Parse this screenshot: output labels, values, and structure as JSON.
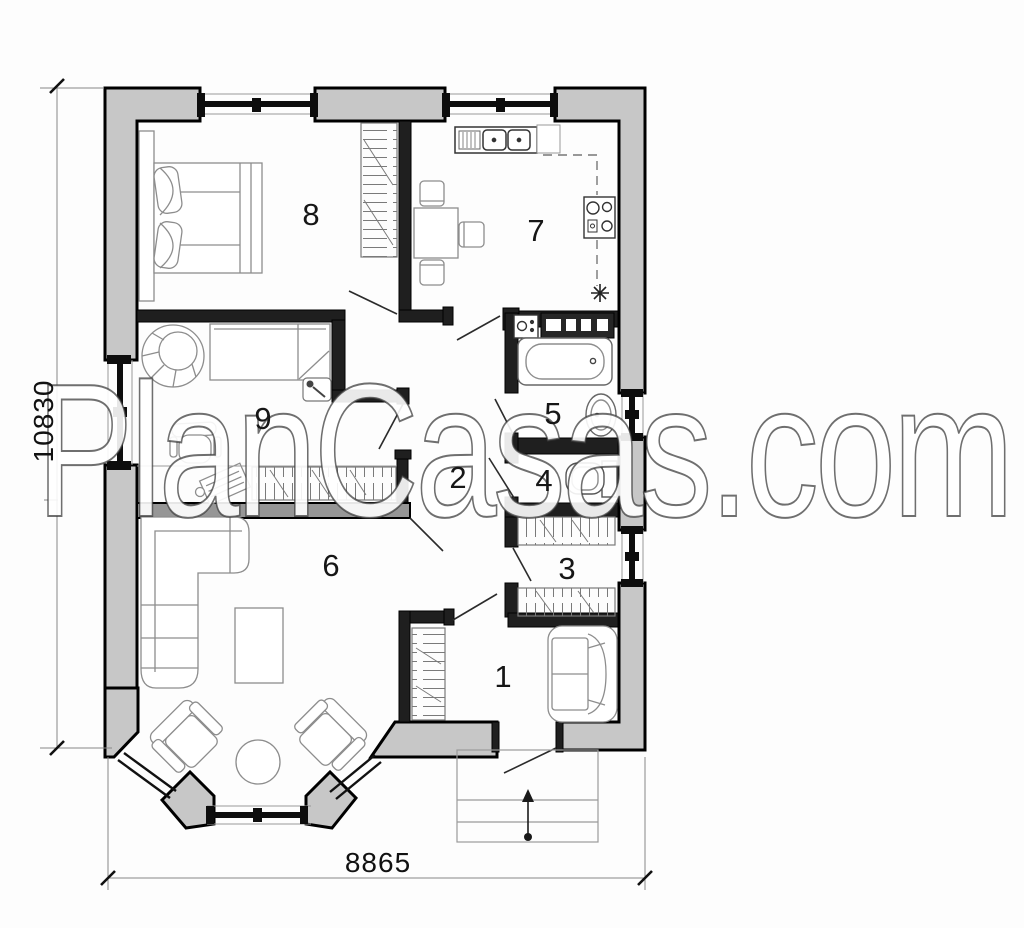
{
  "watermark": {
    "text": "PlanCasas.com"
  },
  "dimensions": {
    "height_mm": "10830",
    "width_mm": "8865"
  },
  "rooms": [
    {
      "label": "1"
    },
    {
      "label": "2"
    },
    {
      "label": "3"
    },
    {
      "label": "4"
    },
    {
      "label": "5"
    },
    {
      "label": "6"
    },
    {
      "label": "7"
    },
    {
      "label": "8"
    },
    {
      "label": "9"
    }
  ],
  "colors": {
    "exterior_wall": "#c7c7c7",
    "interior_wall": "#1f1f1f",
    "partition_wall": "#969696",
    "furniture_line": "#8d8d8d",
    "background": "#fdfdfd"
  }
}
